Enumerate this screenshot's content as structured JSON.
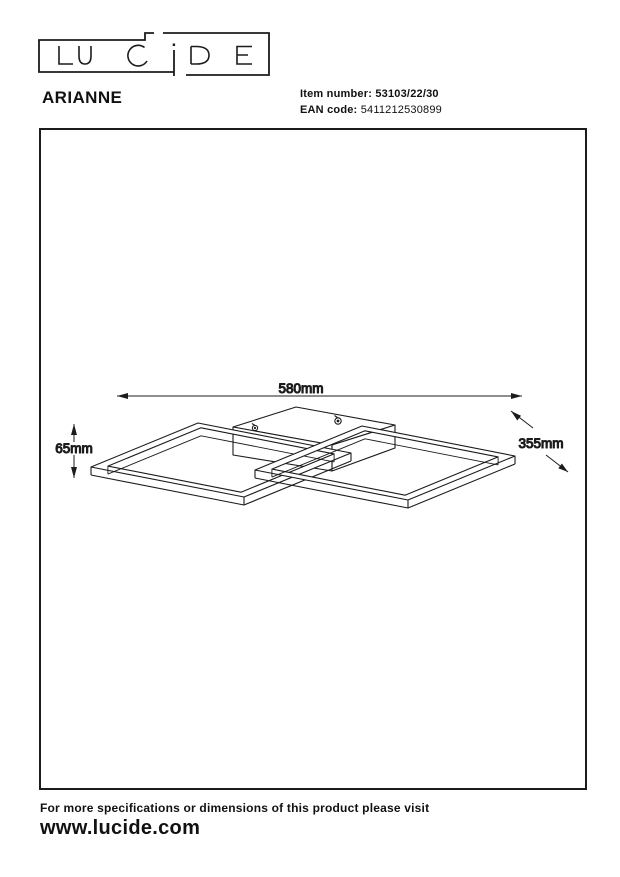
{
  "brand": {
    "logo_text": "LUCIDE"
  },
  "header": {
    "product_name": "ARIANNE",
    "item_number_label": "Item number:",
    "item_number_value": "53103/22/30",
    "ean_label": "EAN code:",
    "ean_value": "5411212530899"
  },
  "drawing": {
    "type": "isometric technical dimension drawing of ceiling lamp with two interlocked square frames and center canopy",
    "dim_width": "580mm",
    "dim_height": "65mm",
    "dim_depth": "355mm"
  },
  "footer": {
    "note": "For more specifications or dimensions of this product please visit",
    "website": "www.lucide.com"
  },
  "colors": {
    "line": "#1c1c1c",
    "background": "#ffffff"
  }
}
